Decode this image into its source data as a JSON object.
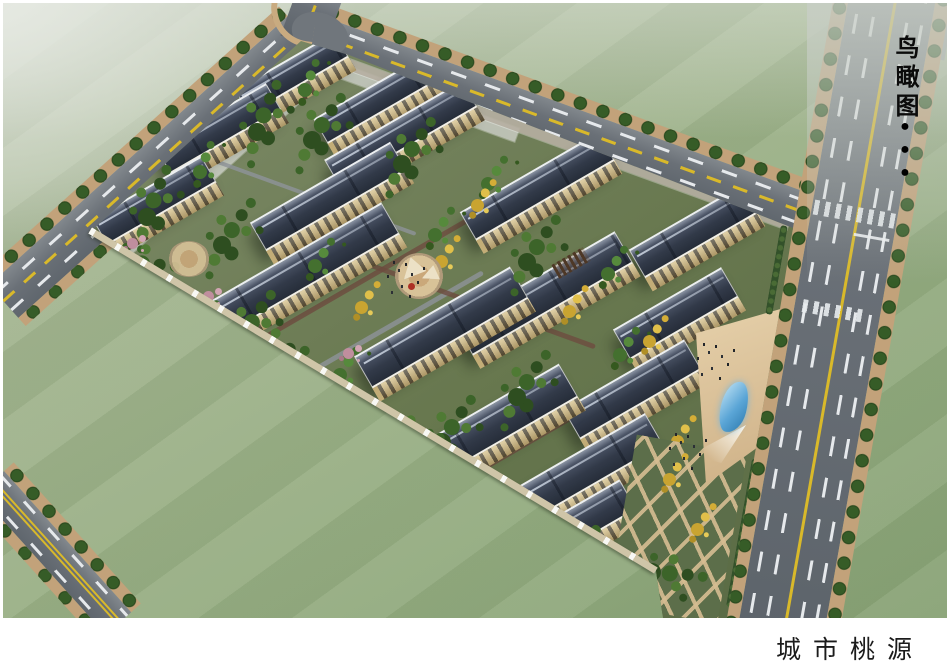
{
  "meta": {
    "type": "architectural-aerial-rendering"
  },
  "labels": {
    "view_type_vertical": "鸟瞰图",
    "project_title": "城市桃源"
  },
  "decorations": {
    "bullet_dots": [
      "●",
      "●",
      "●"
    ]
  },
  "palette": {
    "field_green": "#9db388",
    "asphalt_gray": "#6a7077",
    "lane_yellow": "#d9b92a",
    "roof_slate": "#323a49",
    "roof_trim_white": "#f2efe8",
    "facade_beige": "#d5bf87",
    "tree_green": "#3c6429",
    "tree_autumn": "#d4ad37",
    "blossom_pink": "#c08e9e",
    "sidewalk_tan": "#c2a27a",
    "water_blue": "#5aa5d6",
    "canopy_cream": "#ece1c6",
    "flowerbed_red": "#ad3024",
    "fence_beige": "#cfc5a8",
    "caption_black": "#1b1b1b"
  }
}
